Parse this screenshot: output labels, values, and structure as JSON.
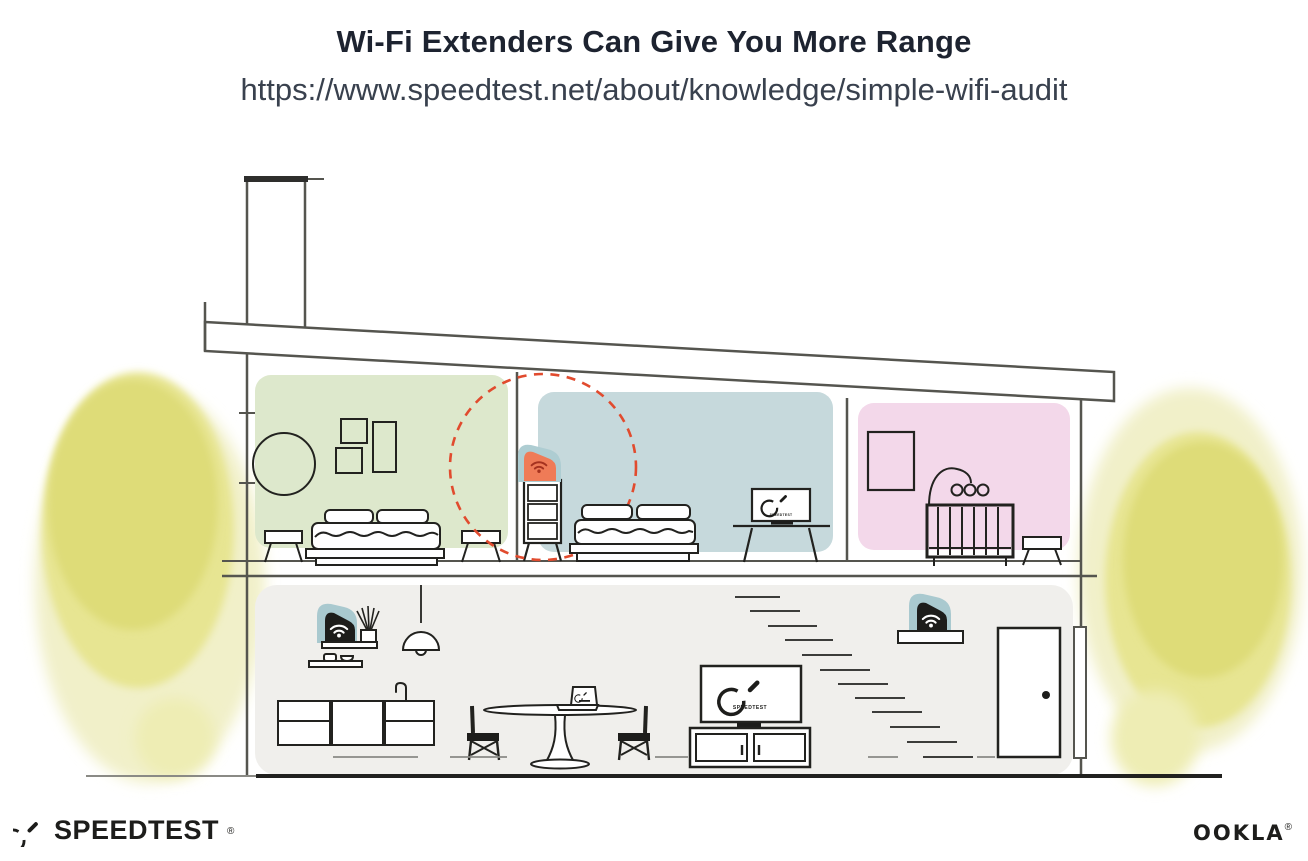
{
  "header": {
    "title": "Wi-Fi Extenders Can Give You More Range",
    "url": "https://www.speedtest.net/about/knowledge/simple-wifi-audit"
  },
  "illustration": {
    "bedroom_tv_label": "SPEEDTEST",
    "living_room_tv_label": "SPEEDTEST",
    "colors": {
      "extender_orange": "#EF7B57",
      "extender_badge_teal": "#AECDD2",
      "range_circle_red": "#E14B2E",
      "bedroom_green": "#DDE8CC",
      "bedroom_blue": "#C6D9DC",
      "nursery_pink": "#F3D8EA",
      "downstairs_gray": "#F0EFEC",
      "tree_yellow": "#E2E07C",
      "line_dark": "#1D1D1B",
      "wall_gray": "#55554F"
    }
  },
  "footer": {
    "speedtest_wordmark": "SPEEDTEST",
    "speedtest_reg": "®",
    "ookla_wordmark": "OOKLA",
    "ookla_reg": "®"
  }
}
